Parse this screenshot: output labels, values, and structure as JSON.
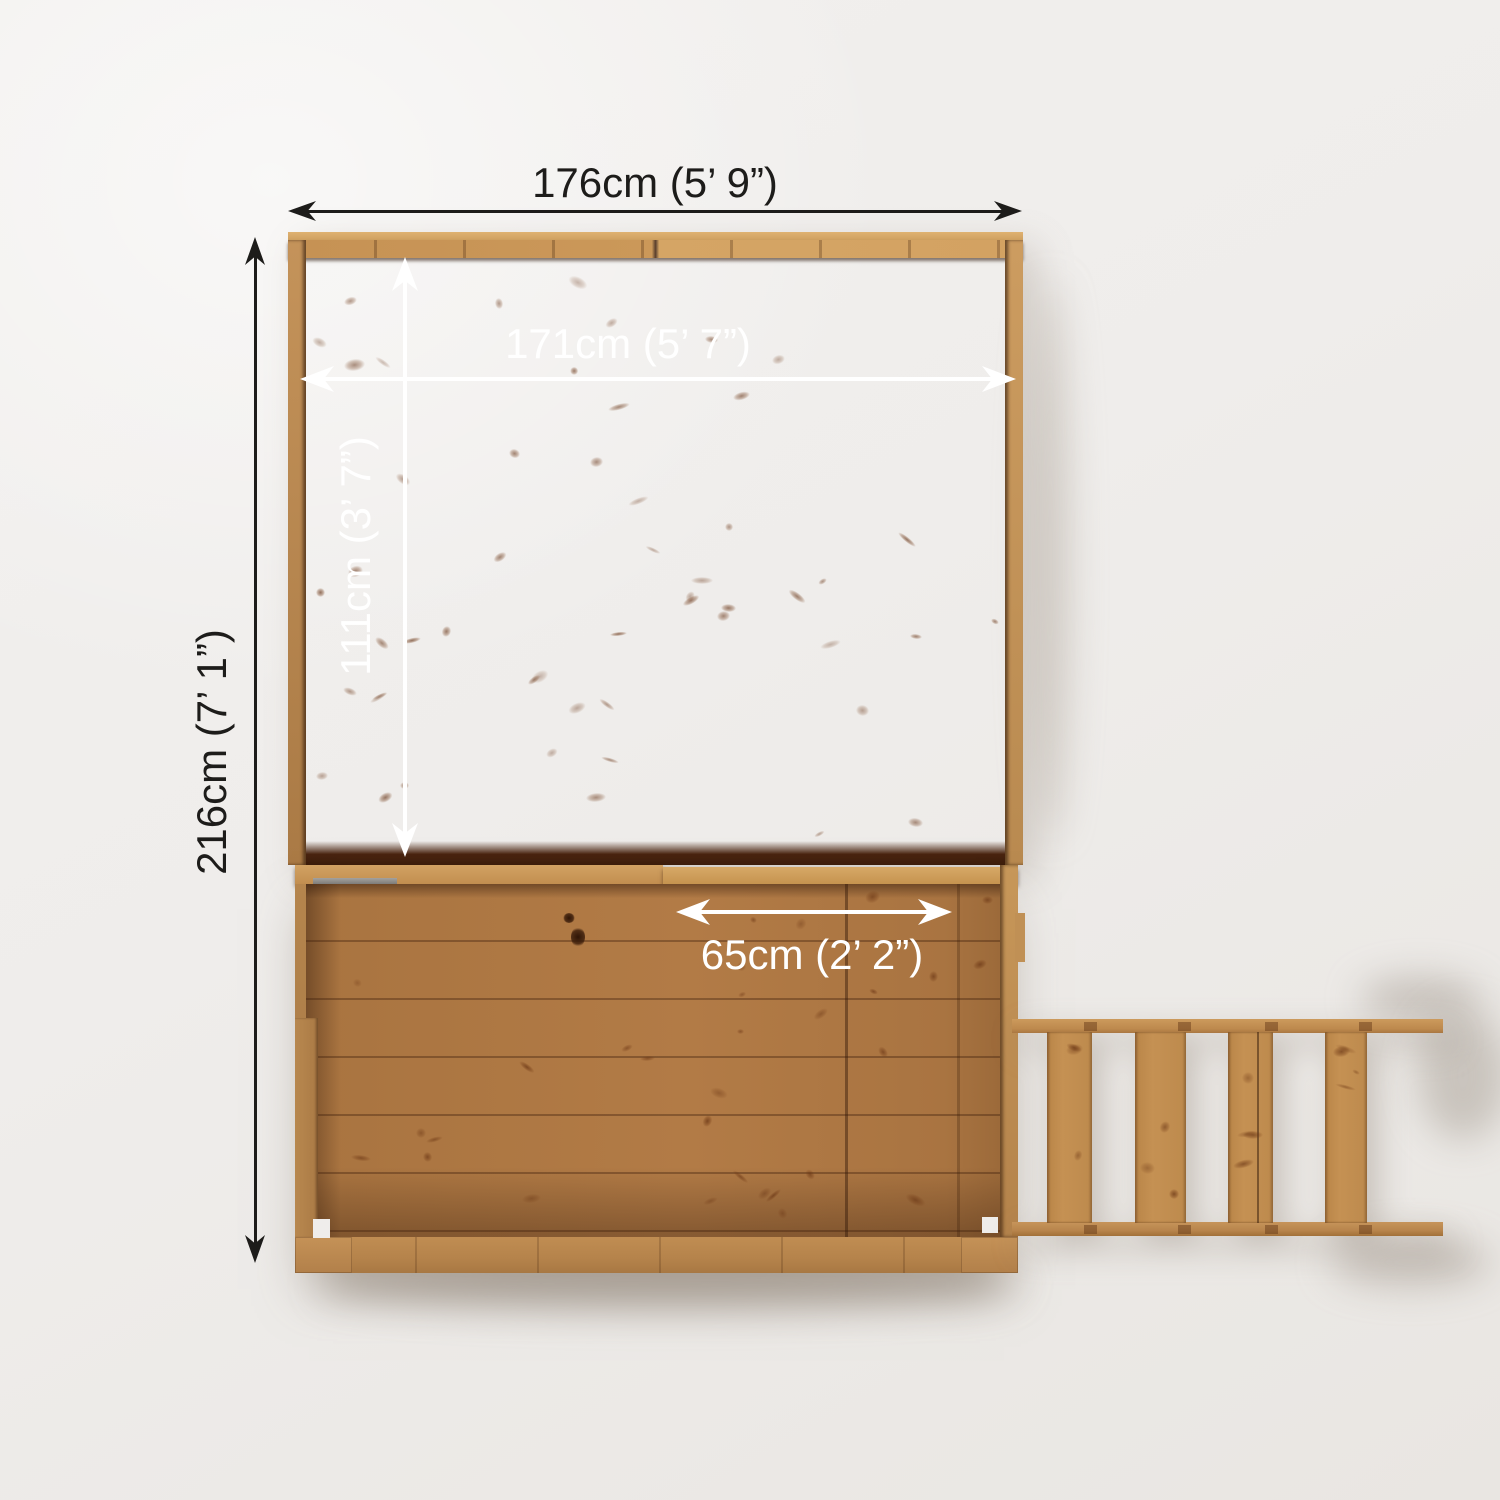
{
  "image": {
    "type": "product-dimension-diagram",
    "subject": "Wooden playhouse with balcony deck and access ladder, top-down plan view",
    "background_color": "#efedeb",
    "wood_color": "#b27b46"
  },
  "annotation_colors": {
    "outer_dimension_lines": "#1d1c1a",
    "inner_dimension_lines": "#ffffff"
  },
  "dimensions": {
    "outer_width": {
      "label": "176cm (5’ 9”)",
      "cm": 176
    },
    "inner_width": {
      "label": "171cm (5’ 7”)",
      "cm": 171
    },
    "inner_depth": {
      "label": "111cm (3’ 7”)",
      "cm": 111
    },
    "outer_depth": {
      "label": "216cm (7’ 1”)",
      "cm": 216
    },
    "opening_width": {
      "label": "65cm (2’ 2”)",
      "cm": 65
    }
  },
  "parts": {
    "roof": "playhouse roof / upper floor panel",
    "deck": "balcony deck",
    "ladder": "access ladder"
  }
}
